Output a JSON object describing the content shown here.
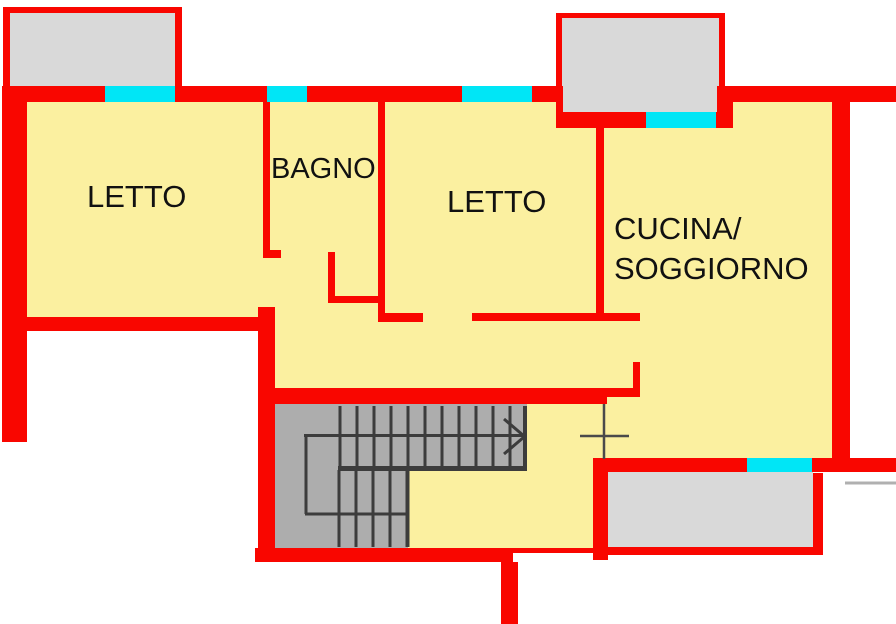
{
  "plan": {
    "type": "floor-plan",
    "rooms": [
      {
        "id": "letto-1",
        "label": "LETTO"
      },
      {
        "id": "bagno",
        "label": "BAGNO"
      },
      {
        "id": "letto-2",
        "label": "LETTO"
      },
      {
        "id": "cucina-soggiorno",
        "label_line1": "CUCINA/",
        "label_line2": "SOGGIORNO"
      }
    ],
    "features": {
      "balconies_count": 3,
      "windows_count": 5,
      "staircase": "switchback-stair-with-up-arrow",
      "markers": [
        "level-cross-marker",
        "boundary-line-right"
      ]
    }
  },
  "colors": {
    "wall_red": "#f90600",
    "floor_yellow": "#fbf0a0",
    "window_cyan": "#00e6f6",
    "balcony_gray": "#d9d9d9",
    "stair_gray": "#adadad",
    "stair_line_dark": "#3c3c3c",
    "marker_gray": "#4a4a4a",
    "text_black": "#111111",
    "background_white": "#ffffff"
  }
}
